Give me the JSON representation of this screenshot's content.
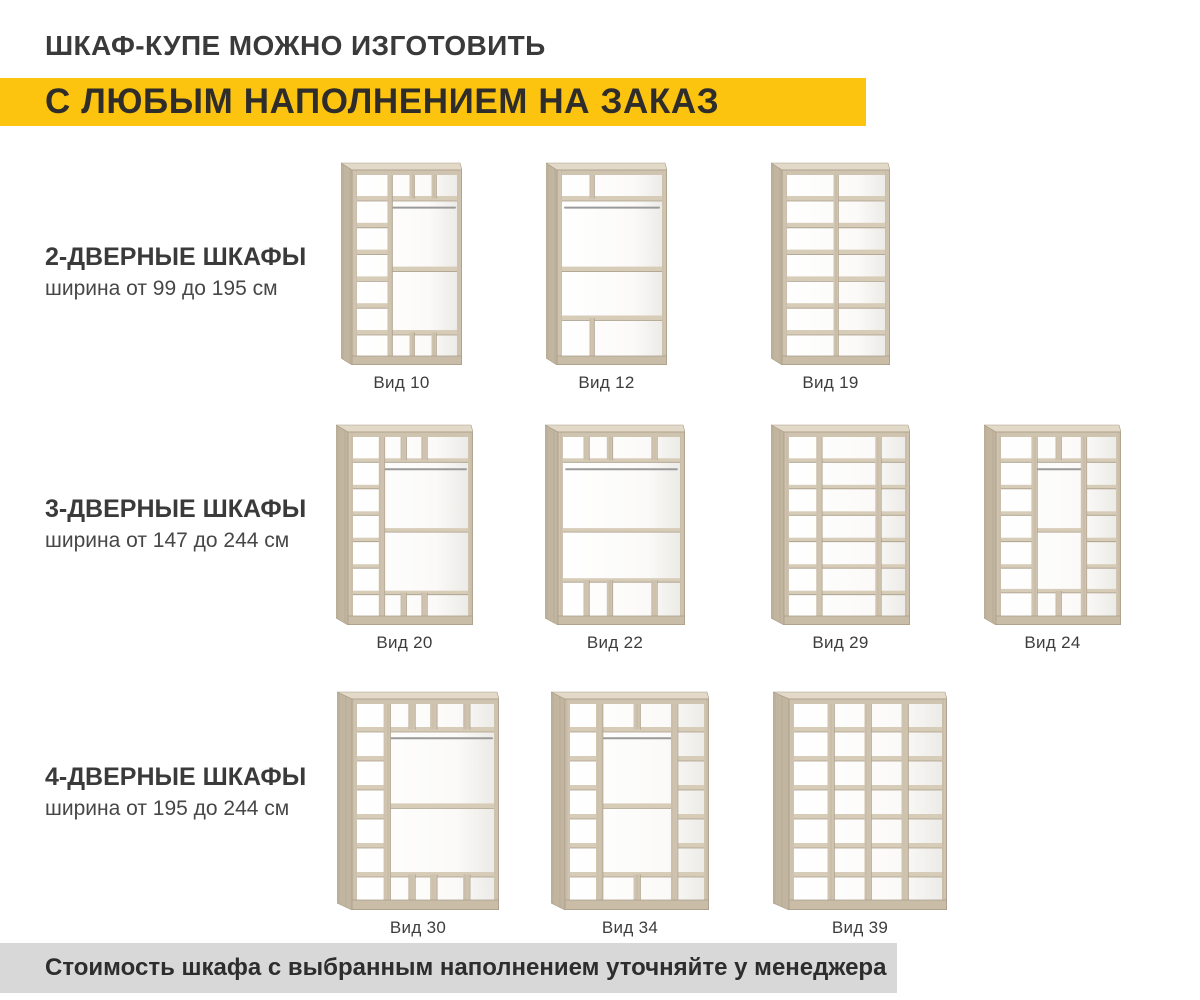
{
  "page": {
    "title": "ШКАФ-КУПЕ МОЖНО ИЗГОТОВИТЬ",
    "subtitle": "С ЛЮБЫМ НАПОЛНЕНИЕМ НА ЗАКАЗ",
    "footer": "Стоимость шкафа с выбранным наполнением уточняйте у менеджера"
  },
  "palette": {
    "accent_yellow": "#fcc40e",
    "footer_gray": "#d8d8d8",
    "text_dark": "#3a3a3a",
    "wood_frame": "#cfc4b0",
    "wood_shelf": "#d7ccb8",
    "wood_side": "#c2b6a1",
    "wood_top": "#e2d9c8",
    "wood_edge": "#a99d88",
    "wood_plinth": "#c9bda8",
    "rod_gray": "#9a9a9a"
  },
  "rows": [
    {
      "heading": "2-ДВЕРНЫЕ ШКАФЫ",
      "subheading": "ширина от 99 до 195 см",
      "figures": [
        {
          "label": "Вид 10",
          "x": 341,
          "y": 162,
          "w": 121,
          "h": 203,
          "dividers": [
            {
              "x": 33,
              "y1": 0,
              "y2": 100
            },
            {
              "x": 55,
              "y1": 0,
              "y2": 13
            },
            {
              "x": 77,
              "y1": 0,
              "y2": 13
            },
            {
              "x": 55,
              "y1": 87,
              "y2": 100
            },
            {
              "x": 77,
              "y1": 87,
              "y2": 100
            }
          ],
          "shelves": [
            {
              "y": 13,
              "x1": 0,
              "x2": 33
            },
            {
              "y": 27.8,
              "x1": 0,
              "x2": 33
            },
            {
              "y": 42.6,
              "x1": 0,
              "x2": 33
            },
            {
              "y": 57.4,
              "x1": 0,
              "x2": 33
            },
            {
              "y": 72.2,
              "x1": 0,
              "x2": 33
            },
            {
              "y": 87,
              "x1": 0,
              "x2": 33
            },
            {
              "y": 13,
              "x1": 33,
              "x2": 100
            },
            {
              "y": 52,
              "x1": 33,
              "x2": 100
            },
            {
              "y": 87,
              "x1": 33,
              "x2": 100
            }
          ],
          "rods": [
            {
              "y": 18,
              "x1": 33,
              "x2": 100
            }
          ]
        },
        {
          "label": "Вид 12",
          "x": 546,
          "y": 162,
          "w": 121,
          "h": 203,
          "dividers": [
            {
              "x": 30,
              "y1": 0,
              "y2": 13
            },
            {
              "x": 30,
              "y1": 79,
              "y2": 100
            }
          ],
          "shelves": [
            {
              "y": 13,
              "x1": 0,
              "x2": 100
            },
            {
              "y": 52,
              "x1": 0,
              "x2": 100
            },
            {
              "y": 79,
              "x1": 0,
              "x2": 100
            }
          ],
          "rods": [
            {
              "y": 18,
              "x1": 1,
              "x2": 99
            }
          ]
        },
        {
          "label": "Вид 19",
          "x": 771,
          "y": 162,
          "w": 119,
          "h": 203,
          "dividers": [
            {
              "x": 50,
              "y1": 0,
              "y2": 100
            }
          ],
          "shelves": [
            {
              "y": 13,
              "x1": 0,
              "x2": 100
            },
            {
              "y": 27.8,
              "x1": 0,
              "x2": 100
            },
            {
              "y": 42.6,
              "x1": 0,
              "x2": 100
            },
            {
              "y": 57.4,
              "x1": 0,
              "x2": 100
            },
            {
              "y": 72.2,
              "x1": 0,
              "x2": 100
            },
            {
              "y": 87,
              "x1": 0,
              "x2": 100
            }
          ],
          "rods": []
        }
      ]
    },
    {
      "heading": "3-ДВЕРНЫЕ ШКАФЫ",
      "subheading": "ширина от 147 до 244 см",
      "figures": [
        {
          "label": "Вид 20",
          "x": 336,
          "y": 424,
          "w": 137,
          "h": 201,
          "dividers": [
            {
              "x": 25,
              "y1": 0,
              "y2": 100
            },
            {
              "x": 44,
              "y1": 0,
              "y2": 13
            },
            {
              "x": 62,
              "y1": 0,
              "y2": 13
            },
            {
              "x": 44,
              "y1": 87,
              "y2": 100
            },
            {
              "x": 62,
              "y1": 87,
              "y2": 100
            }
          ],
          "shelves": [
            {
              "y": 13,
              "x1": 0,
              "x2": 25
            },
            {
              "y": 27.8,
              "x1": 0,
              "x2": 25
            },
            {
              "y": 42.6,
              "x1": 0,
              "x2": 25
            },
            {
              "y": 57.4,
              "x1": 0,
              "x2": 25
            },
            {
              "y": 72.2,
              "x1": 0,
              "x2": 25
            },
            {
              "y": 87,
              "x1": 0,
              "x2": 25
            },
            {
              "y": 13,
              "x1": 25,
              "x2": 100
            },
            {
              "y": 52,
              "x1": 25,
              "x2": 100
            },
            {
              "y": 87,
              "x1": 25,
              "x2": 100
            }
          ],
          "rods": [
            {
              "y": 18,
              "x1": 25,
              "x2": 100
            }
          ]
        },
        {
          "label": "Вид 22",
          "x": 545,
          "y": 424,
          "w": 140,
          "h": 201,
          "dividers": [
            {
              "x": 20,
              "y1": 0,
              "y2": 13
            },
            {
              "x": 40,
              "y1": 0,
              "y2": 13
            },
            {
              "x": 78,
              "y1": 0,
              "y2": 13
            },
            {
              "x": 20,
              "y1": 80,
              "y2": 100
            },
            {
              "x": 40,
              "y1": 80,
              "y2": 100
            },
            {
              "x": 78,
              "y1": 80,
              "y2": 100
            }
          ],
          "shelves": [
            {
              "y": 13,
              "x1": 0,
              "x2": 100
            },
            {
              "y": 52,
              "x1": 0,
              "x2": 100
            },
            {
              "y": 80,
              "x1": 0,
              "x2": 100
            }
          ],
          "rods": [
            {
              "y": 18,
              "x1": 1,
              "x2": 99
            }
          ]
        },
        {
          "label": "Вид 29",
          "x": 771,
          "y": 424,
          "w": 139,
          "h": 201,
          "dividers": [
            {
              "x": 26,
              "y1": 0,
              "y2": 100
            },
            {
              "x": 77,
              "y1": 0,
              "y2": 100
            }
          ],
          "shelves": [
            {
              "y": 13,
              "x1": 0,
              "x2": 100
            },
            {
              "y": 27.8,
              "x1": 0,
              "x2": 100
            },
            {
              "y": 42.6,
              "x1": 0,
              "x2": 100
            },
            {
              "y": 57.4,
              "x1": 0,
              "x2": 100
            },
            {
              "y": 72.2,
              "x1": 0,
              "x2": 100
            },
            {
              "y": 87,
              "x1": 0,
              "x2": 100
            }
          ],
          "rods": []
        },
        {
          "label": "Вид 24",
          "x": 984,
          "y": 424,
          "w": 137,
          "h": 201,
          "dividers": [
            {
              "x": 29,
              "y1": 0,
              "y2": 100
            },
            {
              "x": 72,
              "y1": 0,
              "y2": 100
            },
            {
              "x": 50,
              "y1": 0,
              "y2": 13
            },
            {
              "x": 50,
              "y1": 86,
              "y2": 100
            }
          ],
          "shelves": [
            {
              "y": 13,
              "x1": 0,
              "x2": 29
            },
            {
              "y": 27.8,
              "x1": 0,
              "x2": 29
            },
            {
              "y": 42.6,
              "x1": 0,
              "x2": 29
            },
            {
              "y": 57.4,
              "x1": 0,
              "x2": 29
            },
            {
              "y": 72.2,
              "x1": 0,
              "x2": 29
            },
            {
              "y": 86,
              "x1": 0,
              "x2": 29
            },
            {
              "y": 13,
              "x1": 72,
              "x2": 100
            },
            {
              "y": 27.8,
              "x1": 72,
              "x2": 100
            },
            {
              "y": 42.6,
              "x1": 72,
              "x2": 100
            },
            {
              "y": 57.4,
              "x1": 72,
              "x2": 100
            },
            {
              "y": 72.2,
              "x1": 72,
              "x2": 100
            },
            {
              "y": 86,
              "x1": 72,
              "x2": 100
            },
            {
              "y": 13,
              "x1": 29,
              "x2": 72
            },
            {
              "y": 52,
              "x1": 29,
              "x2": 72
            },
            {
              "y": 86,
              "x1": 29,
              "x2": 72
            }
          ],
          "rods": [
            {
              "y": 18,
              "x1": 29,
              "x2": 72
            }
          ]
        }
      ]
    },
    {
      "heading": "4-ДВЕРНЫЕ ШКАФЫ",
      "subheading": "ширина от 195 до 244 см",
      "figures": [
        {
          "label": "Вид 30",
          "x": 337,
          "y": 691,
          "w": 162,
          "h": 219,
          "dividers": [
            {
              "x": 22,
              "y1": 0,
              "y2": 100
            },
            {
              "x": 40,
              "y1": 0,
              "y2": 13
            },
            {
              "x": 56,
              "y1": 0,
              "y2": 13
            },
            {
              "x": 80,
              "y1": 0,
              "y2": 13
            },
            {
              "x": 40,
              "y1": 87,
              "y2": 100
            },
            {
              "x": 56,
              "y1": 87,
              "y2": 100
            },
            {
              "x": 80,
              "y1": 87,
              "y2": 100
            }
          ],
          "shelves": [
            {
              "y": 13,
              "x1": 0,
              "x2": 22
            },
            {
              "y": 27.8,
              "x1": 0,
              "x2": 22
            },
            {
              "y": 42.6,
              "x1": 0,
              "x2": 22
            },
            {
              "y": 57.4,
              "x1": 0,
              "x2": 22
            },
            {
              "y": 72.2,
              "x1": 0,
              "x2": 22
            },
            {
              "y": 87,
              "x1": 0,
              "x2": 22
            },
            {
              "y": 13,
              "x1": 22,
              "x2": 100
            },
            {
              "y": 52,
              "x1": 22,
              "x2": 100
            },
            {
              "y": 87,
              "x1": 22,
              "x2": 100
            }
          ],
          "rods": [
            {
              "y": 17.5,
              "x1": 22,
              "x2": 100
            }
          ]
        },
        {
          "label": "Вид 34",
          "x": 551,
          "y": 691,
          "w": 158,
          "h": 219,
          "dividers": [
            {
              "x": 22,
              "y1": 0,
              "y2": 100
            },
            {
              "x": 78,
              "y1": 0,
              "y2": 100
            },
            {
              "x": 50,
              "y1": 0,
              "y2": 13
            },
            {
              "x": 50,
              "y1": 87,
              "y2": 100
            }
          ],
          "shelves": [
            {
              "y": 13,
              "x1": 0,
              "x2": 22
            },
            {
              "y": 27.8,
              "x1": 0,
              "x2": 22
            },
            {
              "y": 42.6,
              "x1": 0,
              "x2": 22
            },
            {
              "y": 57.4,
              "x1": 0,
              "x2": 22
            },
            {
              "y": 72.2,
              "x1": 0,
              "x2": 22
            },
            {
              "y": 87,
              "x1": 0,
              "x2": 22
            },
            {
              "y": 13,
              "x1": 78,
              "x2": 100
            },
            {
              "y": 27.8,
              "x1": 78,
              "x2": 100
            },
            {
              "y": 42.6,
              "x1": 78,
              "x2": 100
            },
            {
              "y": 57.4,
              "x1": 78,
              "x2": 100
            },
            {
              "y": 72.2,
              "x1": 78,
              "x2": 100
            },
            {
              "y": 87,
              "x1": 78,
              "x2": 100
            },
            {
              "y": 13,
              "x1": 22,
              "x2": 78
            },
            {
              "y": 52,
              "x1": 22,
              "x2": 78
            },
            {
              "y": 87,
              "x1": 22,
              "x2": 78
            }
          ],
          "rods": [
            {
              "y": 17.5,
              "x1": 22,
              "x2": 78
            }
          ]
        },
        {
          "label": "Вид 39",
          "x": 773,
          "y": 691,
          "w": 174,
          "h": 219,
          "dividers": [
            {
              "x": 25,
              "y1": 0,
              "y2": 100
            },
            {
              "x": 50,
              "y1": 0,
              "y2": 100
            },
            {
              "x": 75,
              "y1": 0,
              "y2": 100
            }
          ],
          "shelves": [
            {
              "y": 13,
              "x1": 0,
              "x2": 100
            },
            {
              "y": 27.8,
              "x1": 0,
              "x2": 100
            },
            {
              "y": 42.6,
              "x1": 0,
              "x2": 100
            },
            {
              "y": 57.4,
              "x1": 0,
              "x2": 100
            },
            {
              "y": 72.2,
              "x1": 0,
              "x2": 100
            },
            {
              "y": 87,
              "x1": 0,
              "x2": 100
            }
          ],
          "rods": []
        }
      ]
    }
  ]
}
